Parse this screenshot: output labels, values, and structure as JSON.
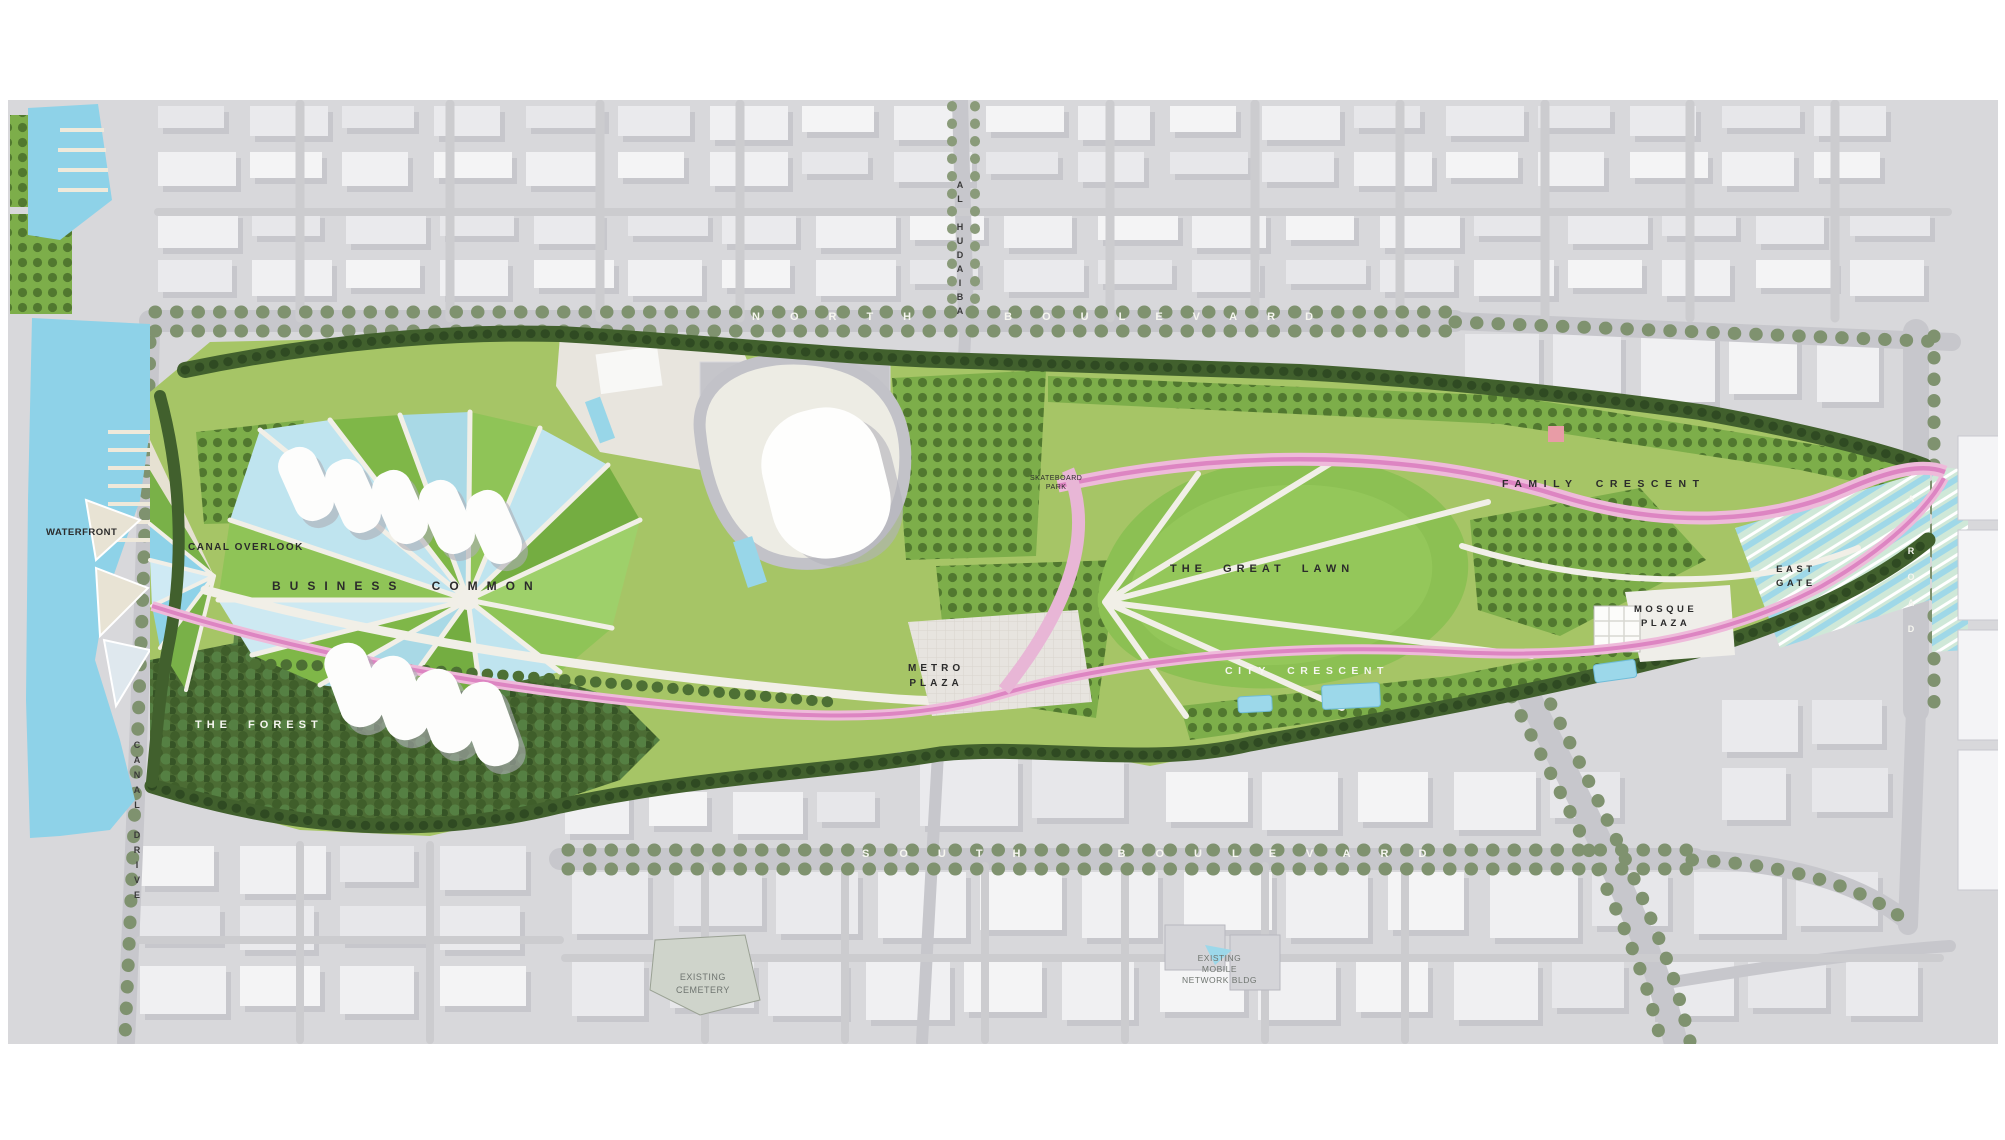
{
  "labels": {
    "park": {
      "waterfront": "WATERFRONT",
      "canal_overlook": "CANAL OVERLOOK",
      "business_common": "BUSINESS COMMON",
      "the_forest": "THE FOREST",
      "great_lawn": "THE GREAT LAWN",
      "city_crescent": "CITY CRESCENT",
      "family_crescent": "FAMILY CRESCENT",
      "metro_plaza": [
        "METRO",
        "PLAZA"
      ],
      "mosque_plaza": [
        "MOSQUE",
        "PLAZA"
      ],
      "east_gate": [
        "EAST",
        "GATE"
      ],
      "skatepark": [
        "SKATEBOARD",
        "PARK"
      ]
    },
    "streets": {
      "north_boulevard": "NORTH BOULEVARD",
      "south_boulevard": "SOUTH BOULEVARD",
      "al_hudaiba": "AL HUDAIBA",
      "canal_drive": "CANAL DRIVE",
      "east_road": "A ROAD"
    },
    "context": {
      "cemetery": [
        "EXISTING",
        "CEMETERY"
      ],
      "mobile": [
        "EXISTING",
        "MOBILE",
        "NETWORK BLDG"
      ]
    }
  },
  "colors": {
    "water": "#8ed2e8",
    "lawn_green": "#8cc053",
    "park_green": "#a6c566",
    "forest_green": "#4c6c34",
    "pink_path": "#dd85c2",
    "city_block": "#efeff1",
    "street_gray": "#c7c7cc",
    "shadow_gray": "#b5b5bd"
  }
}
